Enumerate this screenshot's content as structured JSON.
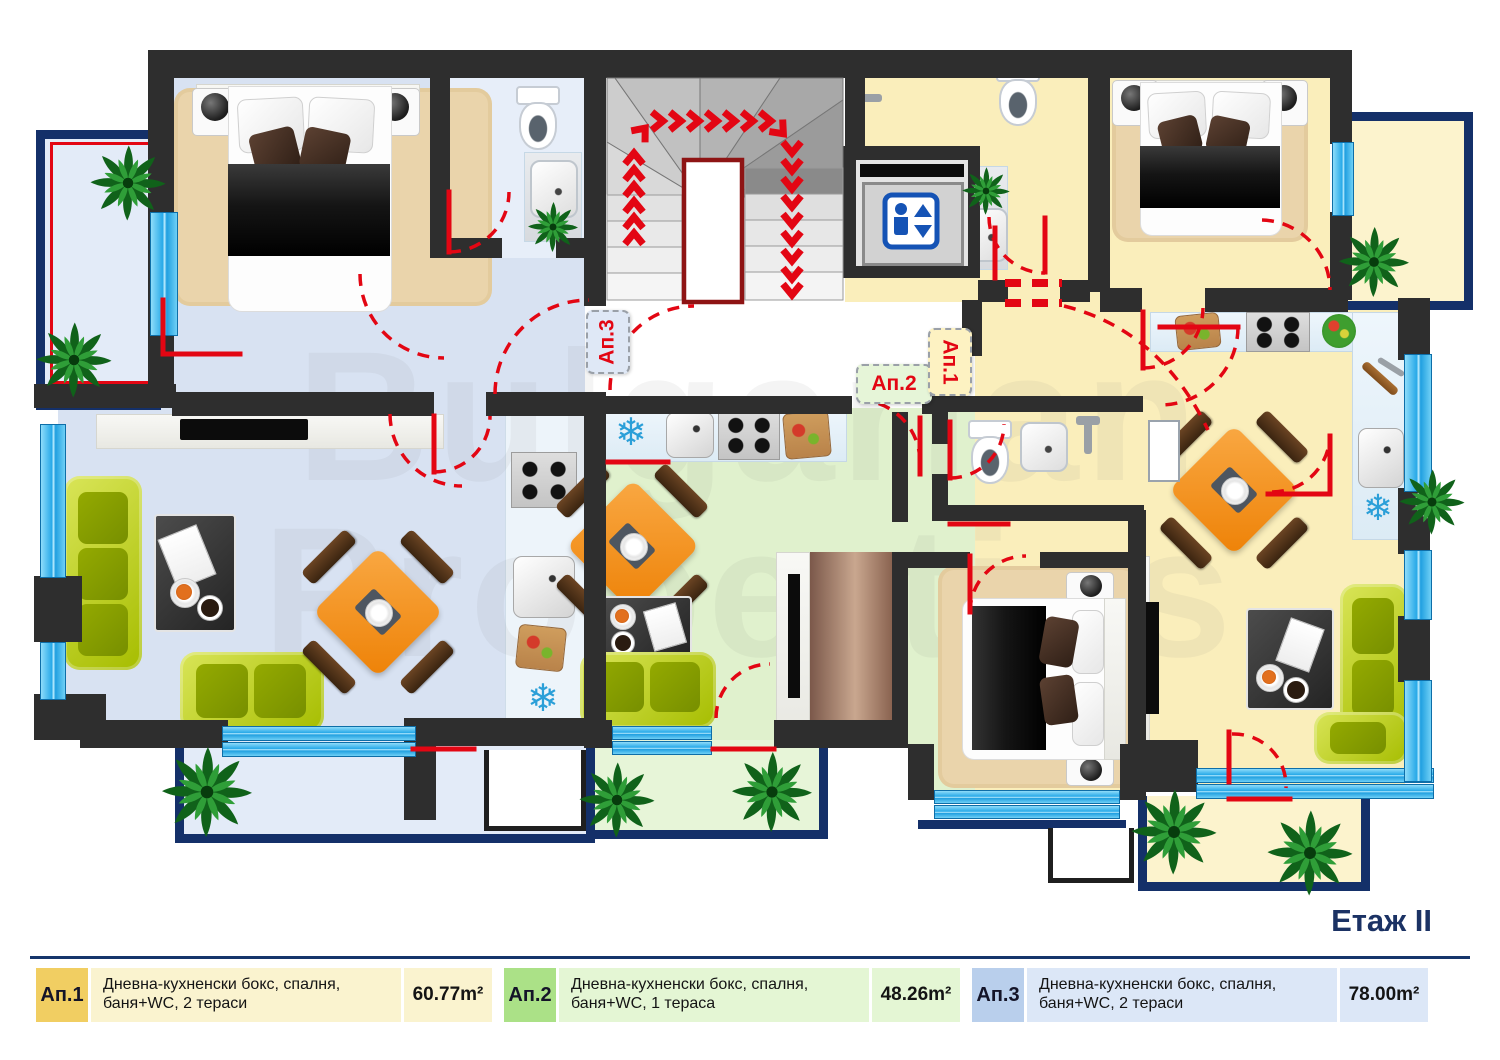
{
  "header": {
    "floor_title": "Етаж II"
  },
  "watermark": {
    "line1": "Bulgarian",
    "line2": "Properties"
  },
  "plan": {
    "apartment_tags": {
      "ap1": "Ап.1",
      "ap2": "Ап.2",
      "ap3": "Ап.3"
    },
    "icons": {
      "snowflake": "❄",
      "elevator": "elevator-person-up-down",
      "stairs_direction": "red-chevron-arrows"
    }
  },
  "legend": {
    "items": [
      {
        "label": "Ап.1",
        "description": "Дневна-кухненски бокс, спалня, баня+WC, 2 тераси",
        "area": "60.77m²",
        "label_color": "#f1ce62",
        "panel_color": "#faf3cf"
      },
      {
        "label": "Ап.2",
        "description": "Дневна-кухненски бокс, спалня, баня+WC, 1 тераса",
        "area": "48.26m²",
        "label_color": "#abe187",
        "panel_color": "#e4f6d4"
      },
      {
        "label": "Ап.3",
        "description": "Дневна-кухненски бокс, спалня, баня+WC, 2 тераси",
        "area": "78.00m²",
        "label_color": "#b9cfec",
        "panel_color": "#dce7f7"
      }
    ]
  },
  "colors": {
    "wall": "#2e2e2e",
    "ap1_floor": "#faeebb",
    "ap2_floor": "#e0f1cd",
    "ap3_floor": "#d8e2f2",
    "accent_red": "#e30613",
    "window_blue": "#27a9e8",
    "terrace_border_navy": "#143069",
    "title_navy": "#1b3264"
  }
}
